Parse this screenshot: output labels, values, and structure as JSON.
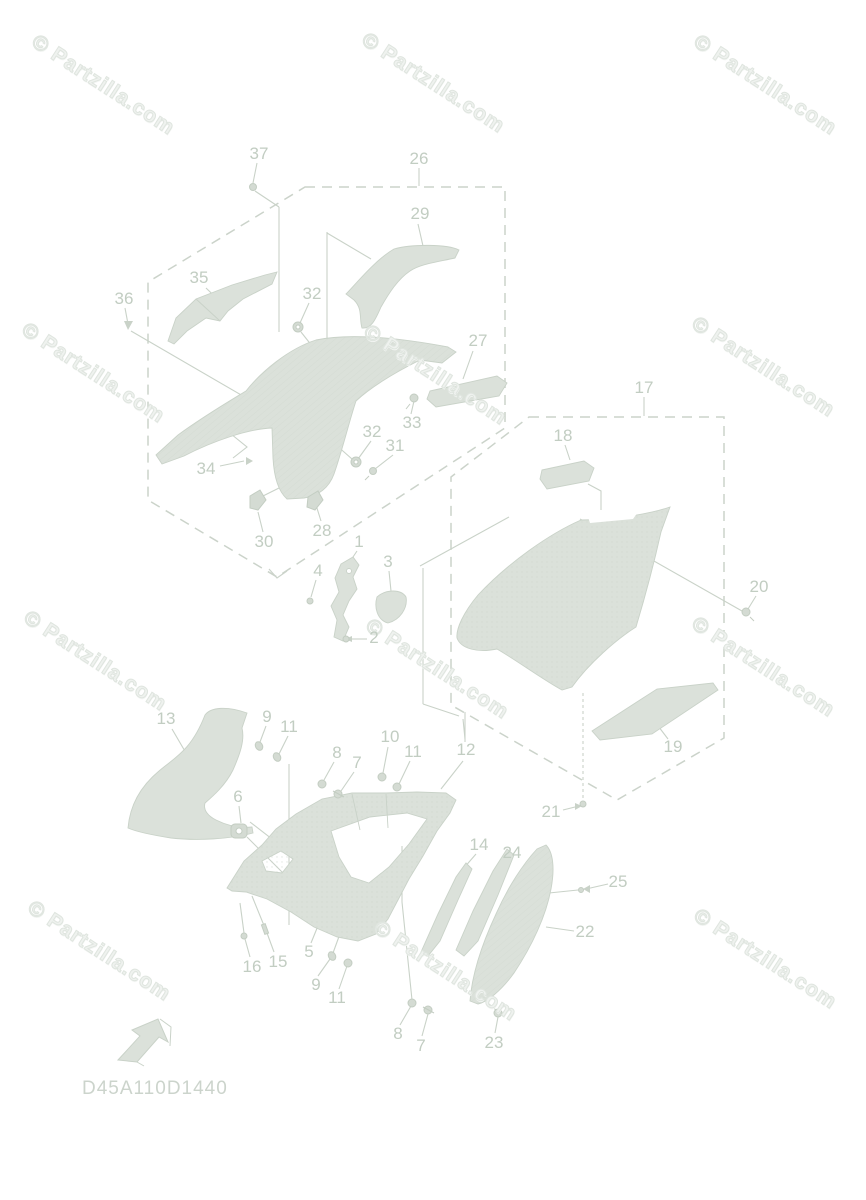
{
  "page": {
    "width": 866,
    "height": 1200,
    "background": "#ffffff"
  },
  "watermark": {
    "text": "© Partzilla.com",
    "color": "#eff2ef",
    "positions": [
      {
        "x": 40,
        "y": 30
      },
      {
        "x": 370,
        "y": 28
      },
      {
        "x": 702,
        "y": 30
      },
      {
        "x": 30,
        "y": 318
      },
      {
        "x": 372,
        "y": 320
      },
      {
        "x": 700,
        "y": 312
      },
      {
        "x": 32,
        "y": 606
      },
      {
        "x": 374,
        "y": 614
      },
      {
        "x": 700,
        "y": 612
      },
      {
        "x": 36,
        "y": 896
      },
      {
        "x": 382,
        "y": 916
      },
      {
        "x": 702,
        "y": 904
      }
    ]
  },
  "diagram": {
    "code": "D45A110D1440",
    "colors": {
      "part_fill": "#dbe1da",
      "part_line": "#c9d2c8",
      "leader_line": "#c9d2c8",
      "dashed_box": "#cbd3ca",
      "callout_text": "#c2cdc2",
      "code_text": "#ccd4cc"
    },
    "groups": [
      {
        "id": "26",
        "label": "26"
      },
      {
        "id": "17",
        "label": "17"
      }
    ],
    "callouts": [
      {
        "id": "37",
        "text": "37",
        "x": 259,
        "y": 154
      },
      {
        "id": "26",
        "text": "26",
        "x": 419,
        "y": 159
      },
      {
        "id": "29",
        "text": "29",
        "x": 420,
        "y": 214
      },
      {
        "id": "35",
        "text": "35",
        "x": 199,
        "y": 278
      },
      {
        "id": "36",
        "text": "36",
        "x": 124,
        "y": 299
      },
      {
        "id": "32a",
        "text": "32",
        "x": 312,
        "y": 294
      },
      {
        "id": "27",
        "text": "27",
        "x": 478,
        "y": 341
      },
      {
        "id": "33",
        "text": "33",
        "x": 412,
        "y": 423
      },
      {
        "id": "32b",
        "text": "32",
        "x": 372,
        "y": 432
      },
      {
        "id": "31",
        "text": "31",
        "x": 395,
        "y": 446
      },
      {
        "id": "34",
        "text": "34",
        "x": 206,
        "y": 469
      },
      {
        "id": "30",
        "text": "30",
        "x": 264,
        "y": 542
      },
      {
        "id": "28",
        "text": "28",
        "x": 322,
        "y": 531
      },
      {
        "id": "1",
        "text": "1",
        "x": 359,
        "y": 542
      },
      {
        "id": "4",
        "text": "4",
        "x": 318,
        "y": 571
      },
      {
        "id": "3",
        "text": "3",
        "x": 388,
        "y": 562
      },
      {
        "id": "2",
        "text": "2",
        "x": 374,
        "y": 638
      },
      {
        "id": "17",
        "text": "17",
        "x": 644,
        "y": 388
      },
      {
        "id": "18",
        "text": "18",
        "x": 563,
        "y": 436
      },
      {
        "id": "20",
        "text": "20",
        "x": 759,
        "y": 587
      },
      {
        "id": "19",
        "text": "19",
        "x": 673,
        "y": 747
      },
      {
        "id": "21",
        "text": "21",
        "x": 551,
        "y": 812
      },
      {
        "id": "13",
        "text": "13",
        "x": 166,
        "y": 719
      },
      {
        "id": "9a",
        "text": "9",
        "x": 267,
        "y": 717
      },
      {
        "id": "11a",
        "text": "11",
        "x": 289,
        "y": 727
      },
      {
        "id": "8a",
        "text": "8",
        "x": 337,
        "y": 753
      },
      {
        "id": "7a",
        "text": "7",
        "x": 357,
        "y": 763
      },
      {
        "id": "10",
        "text": "10",
        "x": 390,
        "y": 737
      },
      {
        "id": "11b",
        "text": "11",
        "x": 413,
        "y": 752
      },
      {
        "id": "12",
        "text": "12",
        "x": 466,
        "y": 750
      },
      {
        "id": "6",
        "text": "6",
        "x": 238,
        "y": 797
      },
      {
        "id": "14",
        "text": "14",
        "x": 479,
        "y": 845
      },
      {
        "id": "24",
        "text": "24",
        "x": 512,
        "y": 853
      },
      {
        "id": "25",
        "text": "25",
        "x": 618,
        "y": 882
      },
      {
        "id": "22",
        "text": "22",
        "x": 585,
        "y": 932
      },
      {
        "id": "16",
        "text": "16",
        "x": 252,
        "y": 967
      },
      {
        "id": "15",
        "text": "15",
        "x": 278,
        "y": 962
      },
      {
        "id": "5",
        "text": "5",
        "x": 309,
        "y": 952
      },
      {
        "id": "9b",
        "text": "9",
        "x": 316,
        "y": 985
      },
      {
        "id": "11c",
        "text": "11",
        "x": 337,
        "y": 998
      },
      {
        "id": "8b",
        "text": "8",
        "x": 398,
        "y": 1034
      },
      {
        "id": "7b",
        "text": "7",
        "x": 421,
        "y": 1046
      },
      {
        "id": "23",
        "text": "23",
        "x": 494,
        "y": 1043
      }
    ]
  }
}
